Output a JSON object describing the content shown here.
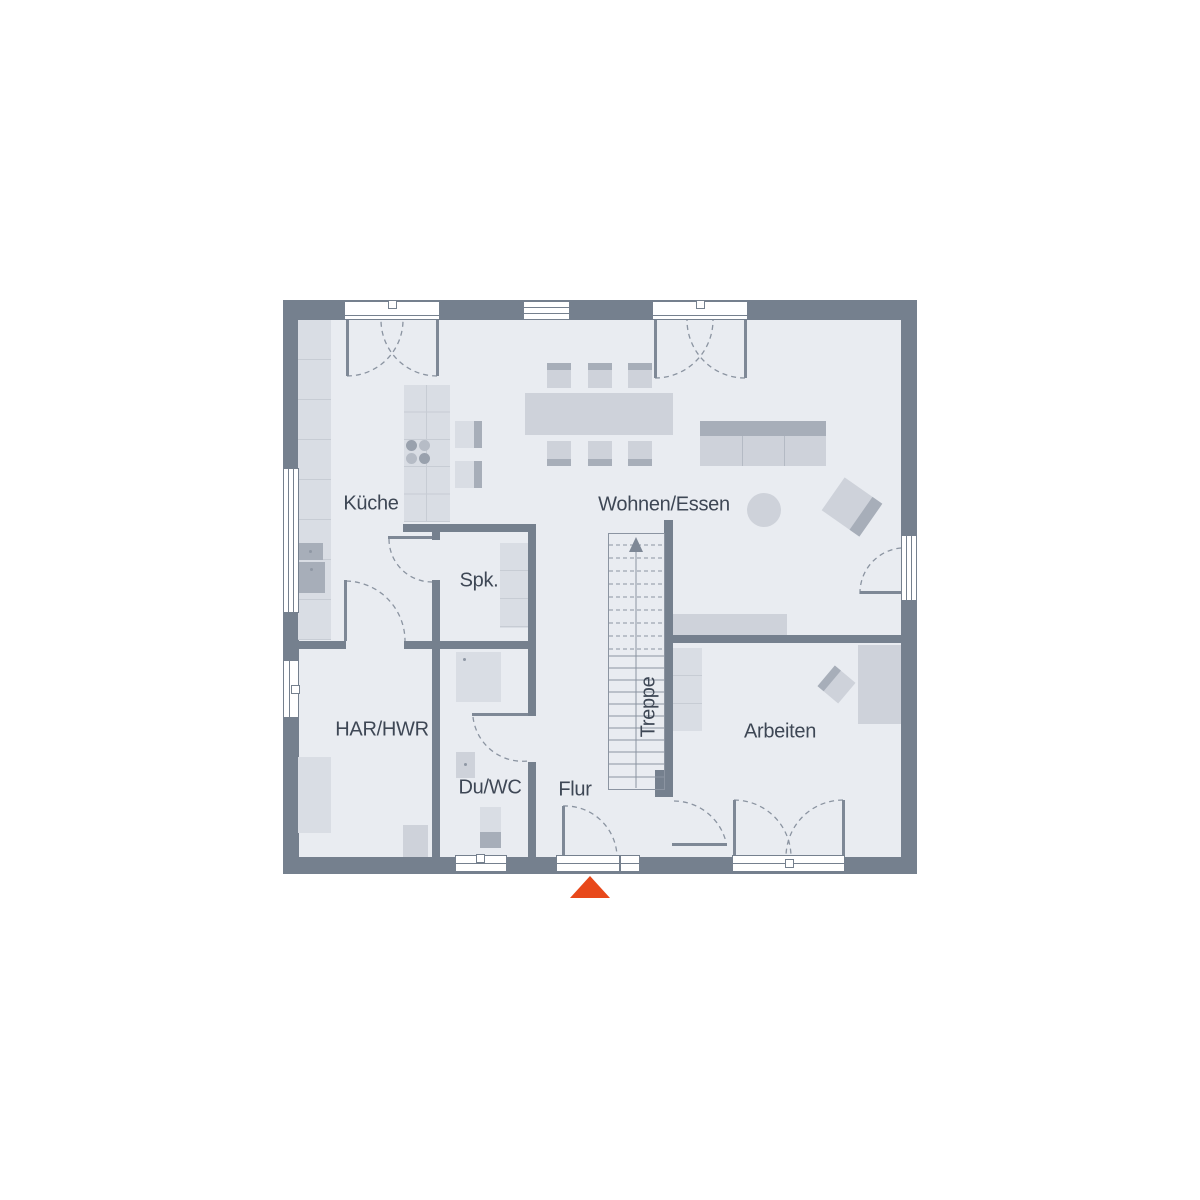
{
  "rooms": {
    "kueche": "Küche",
    "wohnen_essen": "Wohnen/Essen",
    "speisekammer": "Spk.",
    "har_hwr": "HAR/HWR",
    "du_wc": "Du/WC",
    "flur": "Flur",
    "treppe": "Treppe",
    "arbeiten": "Arbeiten"
  },
  "colors": {
    "wall": "#75808e",
    "floor": "#e9ecf1",
    "furniture_light": "#d9dde4",
    "furniture_mid": "#ced2da",
    "furniture_dark": "#a7aeb9",
    "line": "#8b94a1",
    "label_text": "#3e4755",
    "entrance_marker": "#e8481a",
    "background": "#ffffff"
  },
  "icons": {
    "entrance_marker": "triangle-up",
    "stairs_direction": "arrow-up"
  }
}
